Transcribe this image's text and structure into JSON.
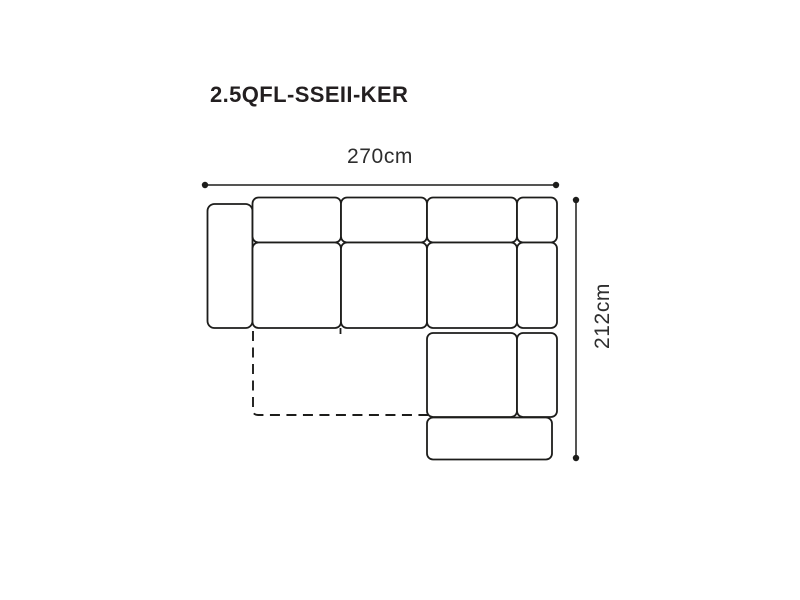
{
  "page": {
    "background": "#ffffff"
  },
  "diagram": {
    "title": "2.5QFL-SSEII-KER",
    "type": "sofa-top-view-dimension-diagram",
    "line_color": "#1d1d1b",
    "title_color": "#231f20",
    "dimension_text_color": "#2e2e2e",
    "dimensions": {
      "width_label": "270cm",
      "height_label": "212cm"
    },
    "pieces": [
      "left-armrest",
      "back-cushion-1",
      "back-cushion-2",
      "back-cushion-3",
      "corner-back-cushion",
      "seat-cushion-1",
      "seat-cushion-2",
      "corner-seat",
      "right-armrest-upper",
      "chaise-seat",
      "right-armrest-lower",
      "ottoman",
      "pull-out-bed-outline-dashed"
    ]
  }
}
